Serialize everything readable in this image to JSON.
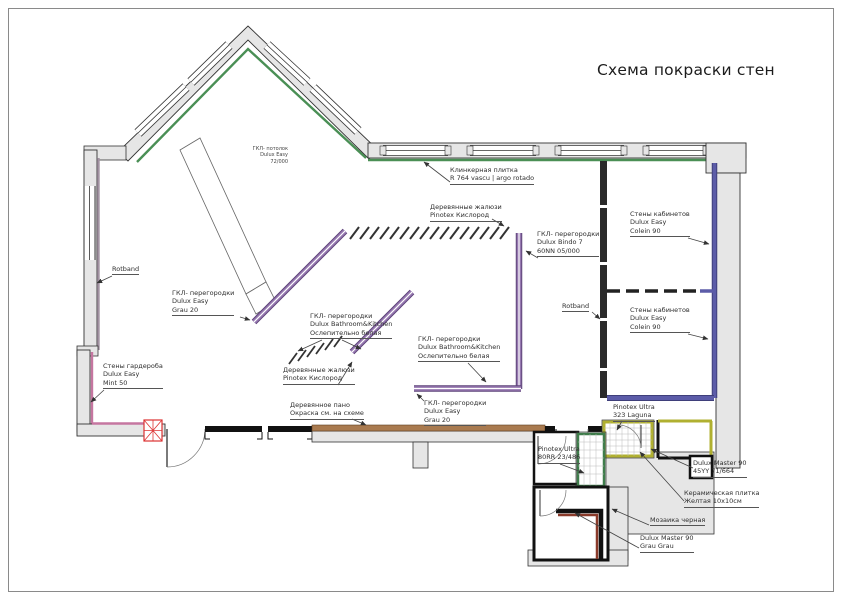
{
  "title": "Схема покраски стен",
  "labels": {
    "ceiling": {
      "l1": "ГКЛ- потолок",
      "l2": "Dulux Easy",
      "l3": "72/000"
    },
    "klinker": {
      "l1": "Клинкерная плитка",
      "l2": "R 764 vascu | argo rotado"
    },
    "jalousie_top": {
      "l1": "Деревянные жалюзи",
      "l2": "Pinotex Кислород"
    },
    "bindo": {
      "l1": "ГКЛ- перегородки",
      "l2": "Dulux Bindo 7",
      "l3": "60NN 05/000"
    },
    "office_upper": {
      "l1": "Стены кабинетов",
      "l2": "Dulux Easy",
      "l3": "Colein 90"
    },
    "office_lower": {
      "l1": "Стены кабинетов",
      "l2": "Dulux Easy",
      "l3": "Colein 90"
    },
    "rotband_left": {
      "l1": "Rotband"
    },
    "rotband_right": {
      "l1": "Rotband"
    },
    "gkl_grau_left": {
      "l1": "ГКЛ- перегородки",
      "l2": "Dulux Easy",
      "l3": "Grau 20"
    },
    "bk_center": {
      "l1": "ГКЛ- перегородки",
      "l2": "Dulux Bathroom&Kitchen",
      "l3": "Ослепительно белая"
    },
    "jalousie_bottom": {
      "l1": "Деревянные жалюзи",
      "l2": "Pinotex Кислород"
    },
    "bk_right": {
      "l1": "ГКЛ- перегородки",
      "l2": "Dulux Bathroom&Kitchen",
      "l3": "Ослепительно белая"
    },
    "wardrobe": {
      "l1": "Стены гардероба",
      "l2": "Dulux Easy",
      "l3": "Mint 50"
    },
    "wood_panel": {
      "l1": "Деревянное пано",
      "l2": "Окраска см. на схеме"
    },
    "gkl_grau_bottom": {
      "l1": "ГКЛ- перегородки",
      "l2": "Dulux Easy",
      "l3": "Grau 20"
    },
    "laguna": {
      "l1": "Pinotex Ultra",
      "l2": "323 Laguna"
    },
    "pinotex_80rr": {
      "l1": "Pinotex Ultra",
      "l2": "80RR 23/486"
    },
    "master_45yy": {
      "l1": "Dulux Master 90",
      "l2": "45YY 71/664"
    },
    "ceramic": {
      "l1": "Керамическая плитка",
      "l2": "Желтая 10x10см"
    },
    "mosaic": {
      "l1": "Мозаика черная"
    },
    "master_grau": {
      "l1": "Dulux Master 90",
      "l2": "Grau Grau"
    }
  },
  "palette": {
    "accent_green": "#4a8f55",
    "partition_purple": "#9678b0",
    "office_indigo": "#5c5ca8",
    "wardrobe_pink": "#c576a0",
    "left_wall_mauve": "#a393a3",
    "tile_olive": "#b0b030",
    "wood_brown": "#a97a4f",
    "mosaic_dark_red": "#8a3a2a",
    "shaft_red": "#dd3333",
    "wall_grey": "#e6e6e6"
  }
}
